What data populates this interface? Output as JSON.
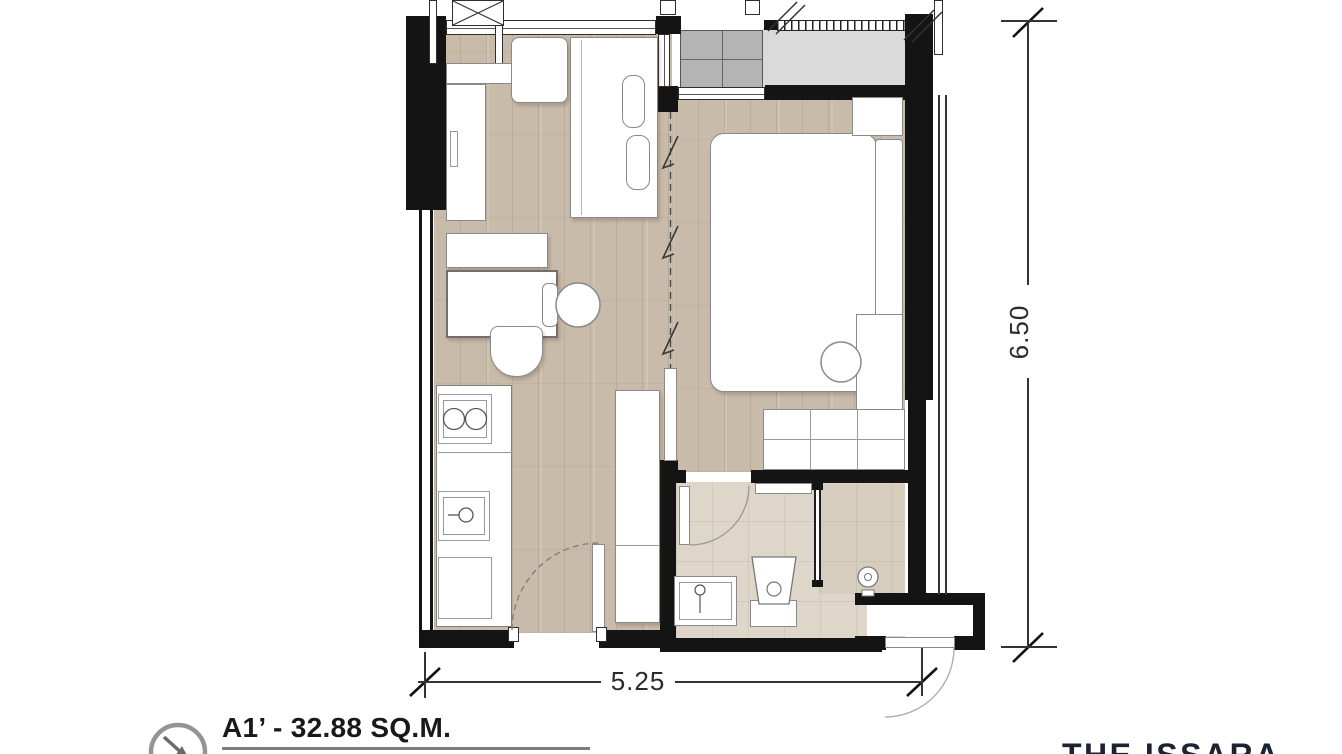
{
  "unit": {
    "label": "A1’ - 32.88 SQ.M."
  },
  "dimensions": {
    "width_m": "5.25",
    "height_m": "6.50"
  },
  "brand": {
    "name": "THE ISSARA"
  },
  "icons": {
    "compass": {
      "name": "compass-arrow-icon",
      "glyph": "↘"
    }
  },
  "colors": {
    "wall": "#141414",
    "wood_floor": "#c9bbaa",
    "tile_floor": "#ded6c8",
    "balcony_floor": "#dadada",
    "ac_platform": "#b4b4b4",
    "furniture_outline": "#8a8a8a",
    "dimension_text": "#2b2b2b",
    "title_text": "#191919",
    "title_underline": "#7d7d7d",
    "brand_text": "#1b2430",
    "compass_gray": "#949494"
  }
}
